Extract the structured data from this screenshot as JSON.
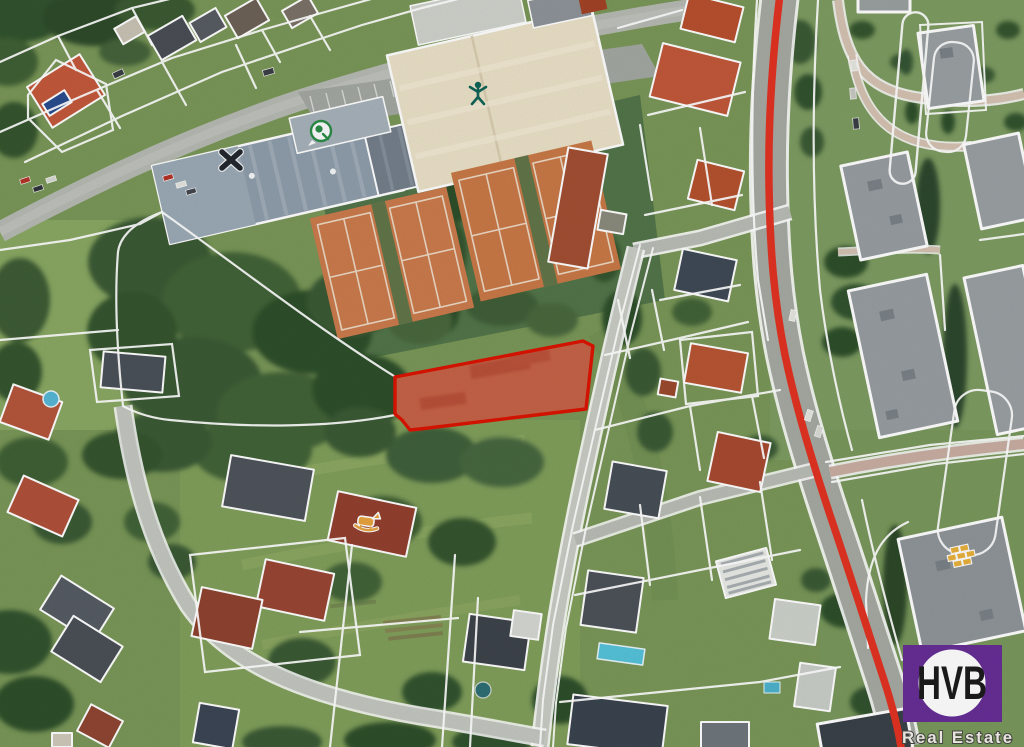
{
  "image": {
    "kind": "aerial cadastral map with highlighted parcel",
    "width_px": 1024,
    "height_px": 747
  },
  "logo": {
    "monogram": "HVB",
    "tagline": "Real Estate",
    "brand_purple": "#672e96",
    "monogram_color": "#1c1c1c",
    "tagline_color": "#f4f1ec"
  },
  "overlay": {
    "highlighted_parcel_stroke": "#dc1402",
    "highlighted_parcel_fill": "rgba(231,64,40,0.42)",
    "route_line_color": "#e23322",
    "parcel_boundary_color": "#ffffff"
  },
  "poi_icons": [
    {
      "name": "sports-person-icon",
      "color": "#0f6457"
    },
    {
      "name": "sports-circle-icon",
      "color": "#2a8c46"
    },
    {
      "name": "cross-marker-icon",
      "color": "#23282e"
    },
    {
      "name": "rocking-horse-icon",
      "color": "#e8a33d"
    },
    {
      "name": "bricks-icon",
      "color": "#e8b13c"
    }
  ],
  "terrain_colors": {
    "grass": "#7a9758",
    "light_grass": "#8fac66",
    "trees": "#3a5a34",
    "tennis_clay": "#cb7b4c",
    "main_road": "#a6aaa3",
    "roof_cream": "#ebe1c8",
    "roof_steel": "#8f9eac",
    "roof_tile_red": "#b5532f",
    "roof_flat_grey": "#969c9f"
  }
}
